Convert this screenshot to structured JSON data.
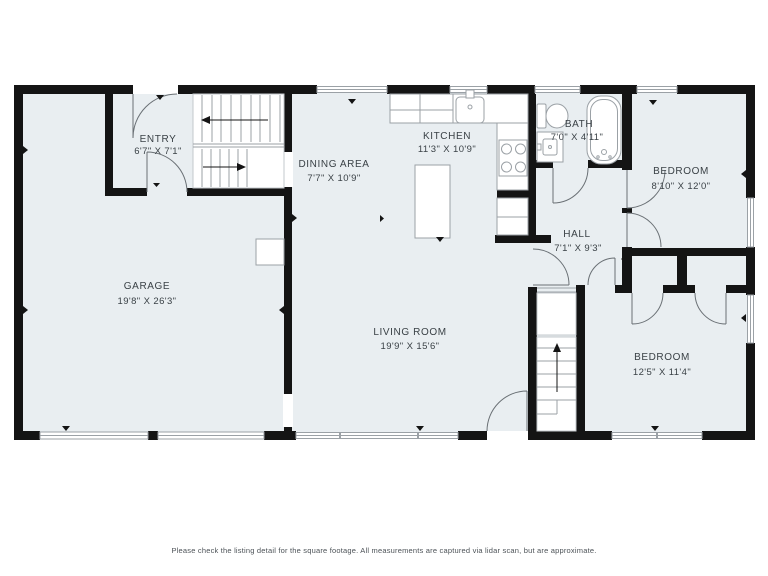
{
  "floor_plan": {
    "rooms": [
      {
        "name": "ENTRY",
        "dimensions": "6'7\" X 7'1\""
      },
      {
        "name": "GARAGE",
        "dimensions": "19'8\" X 26'3\""
      },
      {
        "name": "DINING AREA",
        "dimensions": "7'7\" X 10'9\""
      },
      {
        "name": "KITCHEN",
        "dimensions": "11'3\" X 10'9\""
      },
      {
        "name": "BATH",
        "dimensions": "7'0\" X 4'11\""
      },
      {
        "name": "HALL",
        "dimensions": "7'1\" X 9'3\""
      },
      {
        "name": "LIVING ROOM",
        "dimensions": "19'9\" X 15'6\""
      },
      {
        "name": "BEDROOM",
        "dimensions": "8'10\" X 12'0\""
      },
      {
        "name": "BEDROOM",
        "dimensions": "12'5\" X 11'4\""
      }
    ],
    "footer_note": "Please check the listing detail for the square footage. All measurements are captured via lidar scan, but are approximate.",
    "colors": {
      "background": "#ffffff",
      "floor": "#e9eef1",
      "wall": "#141414",
      "text": "#3a4146"
    }
  }
}
